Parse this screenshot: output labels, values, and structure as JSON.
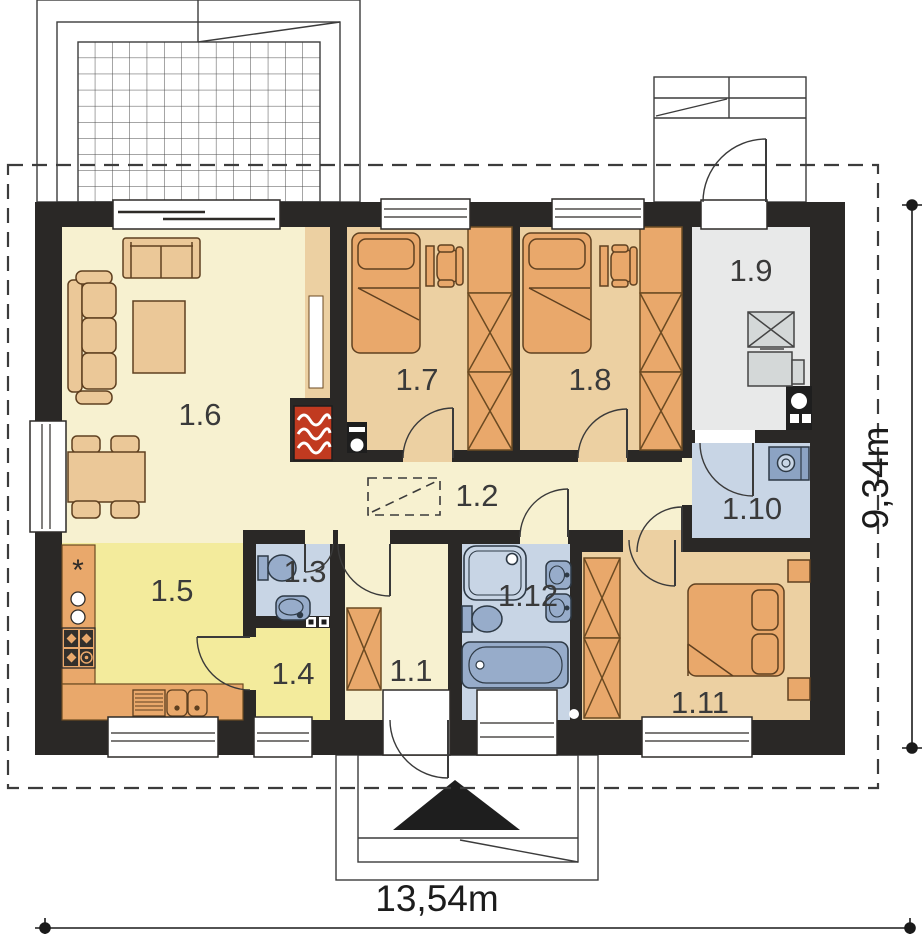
{
  "plan": {
    "name": "single-storey house floor plan"
  },
  "rooms": {
    "r1_1": {
      "label": "1.1"
    },
    "r1_2": {
      "label": "1.2"
    },
    "r1_3": {
      "label": "1.3"
    },
    "r1_4": {
      "label": "1.4"
    },
    "r1_5": {
      "label": "1.5"
    },
    "r1_6": {
      "label": "1.6"
    },
    "r1_7": {
      "label": "1.7"
    },
    "r1_8": {
      "label": "1.8"
    },
    "r1_9": {
      "label": "1.9"
    },
    "r1_10": {
      "label": "1.10"
    },
    "r1_11": {
      "label": "1.11"
    },
    "r1_12": {
      "label": "1.12"
    }
  },
  "dimensions": {
    "width_label": "13,54m",
    "height_label": "9,34m"
  },
  "symbols": {
    "kitchen_star": "*"
  },
  "colors": {
    "wall": "#2a2826",
    "floor_cream": "#f7f1d0",
    "floor_yellow": "#f3eb9c",
    "floor_tan": "#ecd0a2",
    "floor_blue": "#c8d5e5",
    "floor_gray": "#e8e9e9",
    "furniture_orange": "#e9a86b",
    "furniture_wheat": "#ebc898",
    "fixture_blue": "#97acca",
    "fireplace_red": "#c13a20"
  }
}
